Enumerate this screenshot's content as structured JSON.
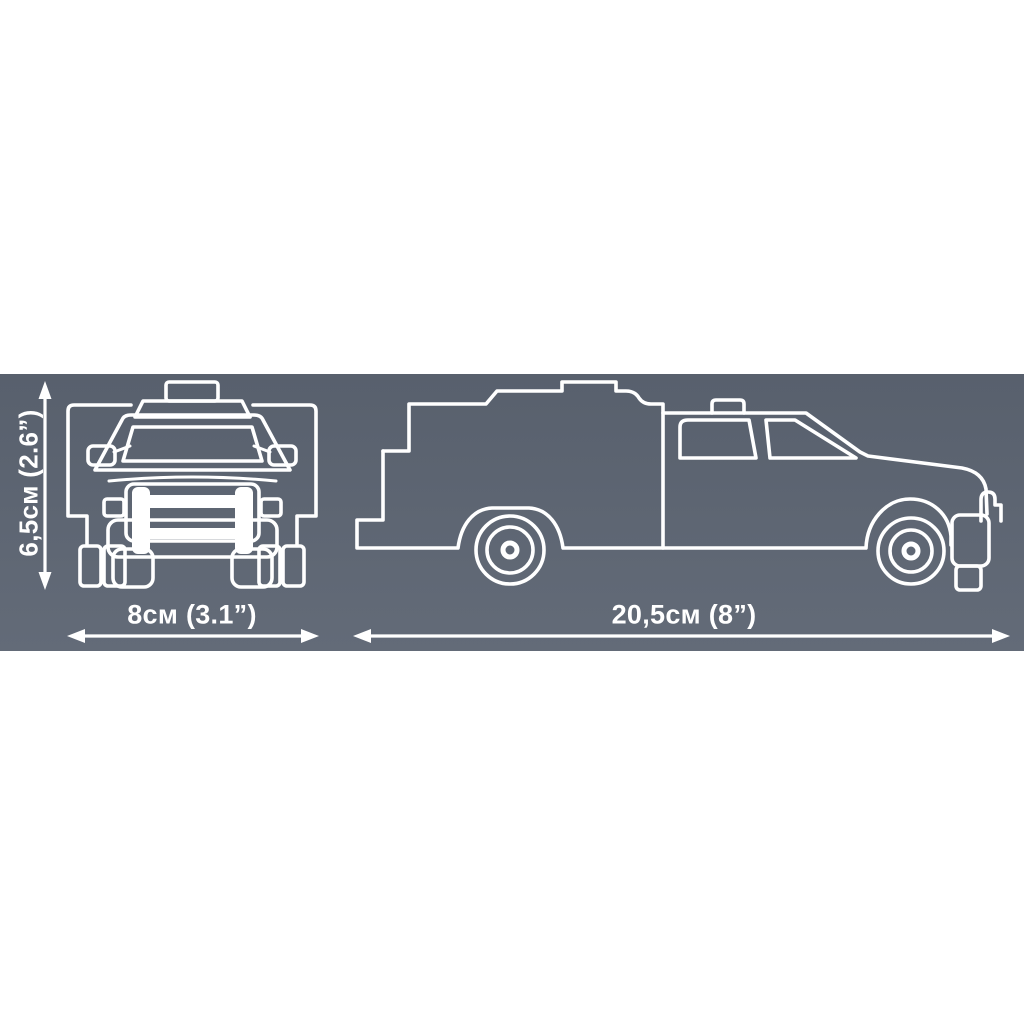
{
  "page": {
    "background_color": "#ffffff"
  },
  "band": {
    "gradient_top": "#58606d",
    "gradient_bottom": "#636b78"
  },
  "artwork": {
    "line_color": "#ffffff"
  },
  "dimensions": {
    "height_label": "6,5см (2.6”)",
    "width_label": "8см (3.1”)",
    "length_label": "20,5см (8”)"
  }
}
